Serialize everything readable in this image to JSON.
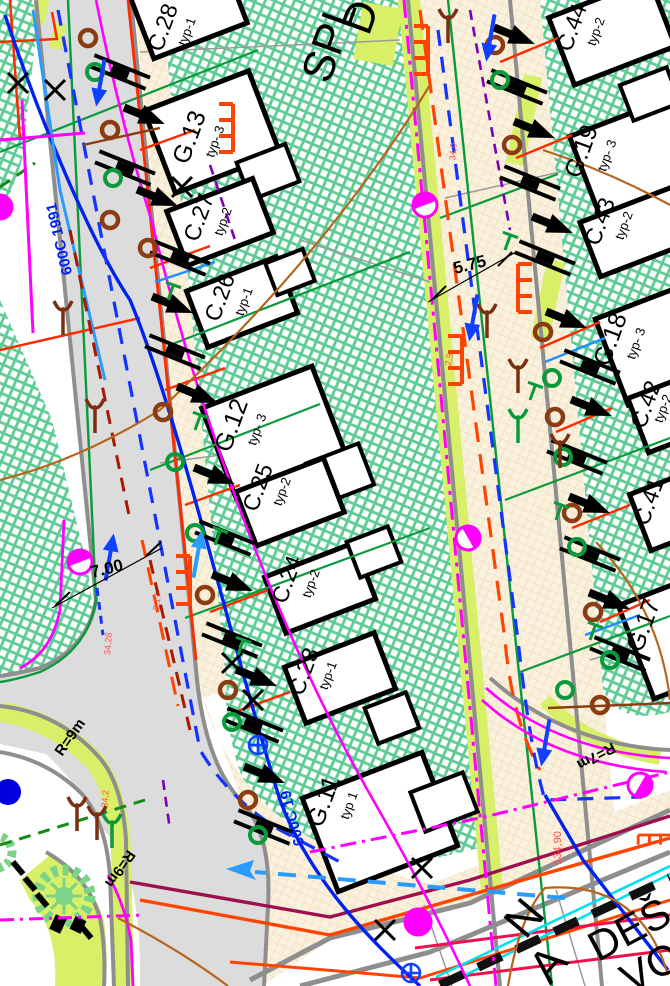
{
  "buildings": [
    {
      "id": "C.28",
      "typ": "typ-1"
    },
    {
      "id": "G.13",
      "typ": "typ- 3"
    },
    {
      "id": "C.27",
      "typ": "typ-2"
    },
    {
      "id": "C.26",
      "typ": "typ-1"
    },
    {
      "id": "G.12",
      "typ": "typ- 3"
    },
    {
      "id": "C.25",
      "typ": "typ-2"
    },
    {
      "id": "C.24",
      "typ": "typ-2"
    },
    {
      "id": "C.23",
      "typ": "typ-1"
    },
    {
      "id": "G.11",
      "typ": "typ 1"
    },
    {
      "id": "C.44",
      "typ": "typ-2"
    },
    {
      "id": "G.19",
      "typ": "typ- 3"
    },
    {
      "id": "C.43",
      "typ": "typ-2"
    },
    {
      "id": "G.18",
      "typ": "typ- 3"
    },
    {
      "id": "C.42",
      "typ": "typ-2"
    },
    {
      "id": "C.41",
      "typ": ""
    },
    {
      "id": "G.17",
      "typ": ""
    }
  ],
  "street_labels": {
    "spl": "SPL",
    "d": "D",
    "des": "DEŠ",
    "vo": "VO",
    "n": "N",
    "a": "A"
  },
  "dimensions": {
    "w1": "7.00",
    "w2": "5.75"
  },
  "curve_radii": {
    "r9a": "R=9m",
    "r9b": "R=9m",
    "r7": "R=7m"
  },
  "water_main": {
    "label1": "600C 1991",
    "label2": "600C 19"
  },
  "elevations": {
    "e1": "134,90",
    "e2": "34,28",
    "e3": "3,17",
    "e4": "2,5",
    "e5": "34,2",
    "e6": "34,0"
  },
  "colors": {
    "hatch_green": "#5ecb95",
    "paver_beige": "#f7eed9",
    "paver_line": "#e8d3a4",
    "asphalt": "#dcdcdc",
    "curb_gray": "#8e8e8e",
    "verge_chartreuse": "#d8ef68",
    "water_blue": "#0022ee",
    "gas_magenta": "#ff00ff",
    "power_red": "#ff3300",
    "sewer_brown": "#8b3c12",
    "telecom_orange": "#ff4400",
    "drain_green": "#0a9a3c",
    "contour_brown": "#b5651d",
    "boundary_maroon": "#9c1050",
    "heat_cyan": "#00e0ee",
    "signal_crimson": "#f0104c",
    "cable_purple": "#7d00b5",
    "flow_dodger": "#2a9bff"
  }
}
